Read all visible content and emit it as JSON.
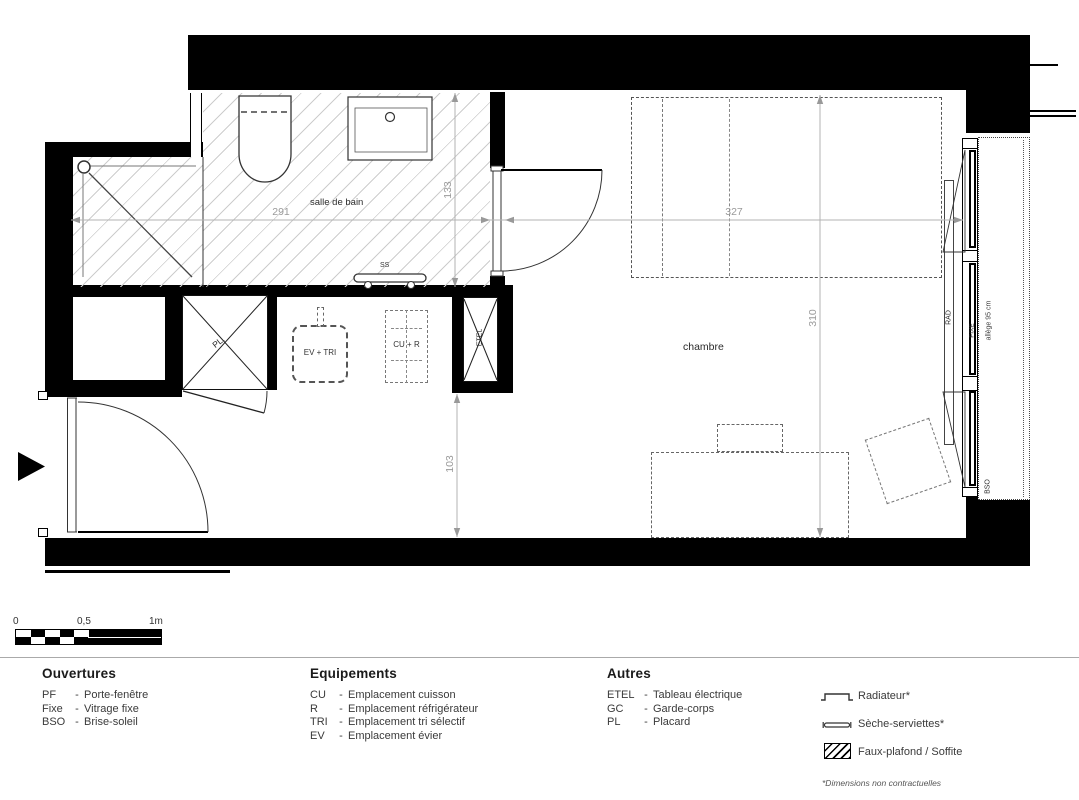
{
  "plan": {
    "rooms": {
      "bathroom": "salle de bain",
      "bedroom": "chambre"
    },
    "dimensions": {
      "bathroom_width": "291",
      "bathroom_depth": "133",
      "bedroom_width": "327",
      "bedroom_depth": "310",
      "passage": "103"
    },
    "fixtures": {
      "towel_dryer": "SS",
      "closet": "PL.",
      "sink_sorting": "EV + TRI",
      "cooking_fridge": "CU + R",
      "electrical_panel": "ETEL",
      "radiator": "RAD",
      "fixed_glazing": "FIXE",
      "sill_height": "allège 95 cm",
      "sun_shade": "BSO"
    }
  },
  "scalebar": {
    "t0": "0",
    "t05": "0,5",
    "t1": "1m"
  },
  "legend": {
    "sep": "-",
    "ouvertures": {
      "title": "Ouvertures",
      "items": [
        {
          "abbr": "PF",
          "label": "Porte-fenêtre"
        },
        {
          "abbr": "Fixe",
          "label": "Vitrage fixe"
        },
        {
          "abbr": "BSO",
          "label": "Brise-soleil"
        }
      ]
    },
    "equipements": {
      "title": "Equipements",
      "items": [
        {
          "abbr": "CU",
          "label": "Emplacement cuisson"
        },
        {
          "abbr": "R",
          "label": "Emplacement réfrigérateur"
        },
        {
          "abbr": "TRI",
          "label": "Emplacement tri sélectif"
        },
        {
          "abbr": "EV",
          "label": "Emplacement évier"
        }
      ]
    },
    "autres": {
      "title": "Autres",
      "items": [
        {
          "abbr": "ETEL",
          "label": "Tableau électrique"
        },
        {
          "abbr": "GC",
          "label": "Garde-corps"
        },
        {
          "abbr": "PL",
          "label": "Placard"
        }
      ]
    },
    "symbols": [
      {
        "label": "Radiateur*"
      },
      {
        "label": "Sèche-serviettes*"
      },
      {
        "label": "Faux-plafond / Soffite"
      }
    ],
    "footnote": "*Dimensions non contractuelles"
  },
  "colors": {
    "wall": "#000000",
    "hatch": "#cdcdcd",
    "dim": "#9a9a9a"
  }
}
